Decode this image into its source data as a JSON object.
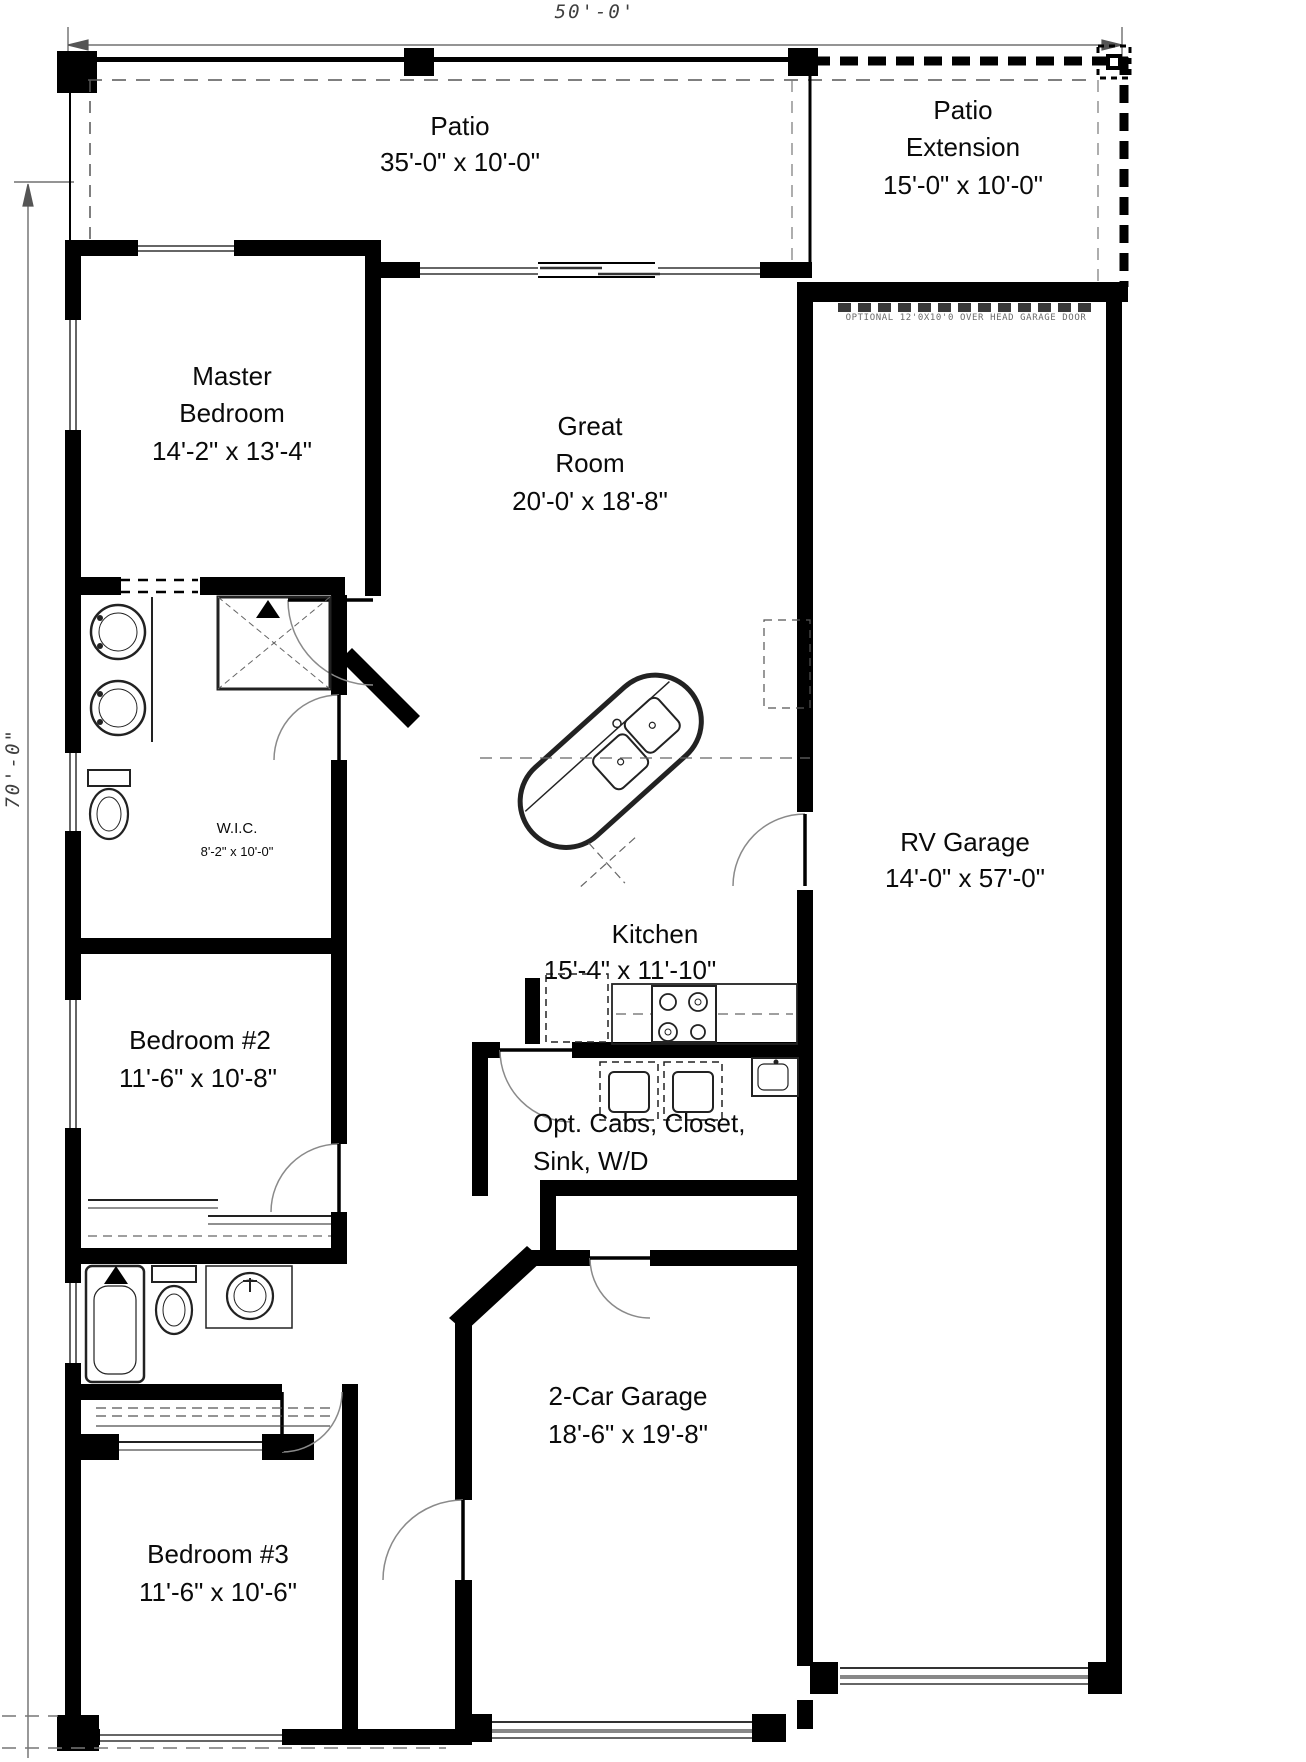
{
  "drawing": {
    "overall_width_label": "50'-0'",
    "overall_depth_label": "70'-0\"",
    "note_rv_door": "OPTIONAL 12'0X10'0 OVER HEAD GARAGE DOOR",
    "rooms": {
      "patio": {
        "name": "Patio",
        "size": "35'-0\" x 10'-0\""
      },
      "patio_extension": {
        "name_line1": "Patio",
        "name_line2": "Extension",
        "size": "15'-0\" x 10'-0\""
      },
      "master_bedroom": {
        "name_line1": "Master",
        "name_line2": "Bedroom",
        "size": "14'-2\" x 13'-4\""
      },
      "great_room": {
        "name_line1": "Great",
        "name_line2": "Room",
        "size": "20'-0' x 18'-8\""
      },
      "wic": {
        "name": "W.I.C.",
        "size": "8'-2\" x 10'-0\""
      },
      "kitchen": {
        "name": "Kitchen",
        "size": "15'-4\" x 11'-10\""
      },
      "rv_garage": {
        "name": "RV Garage",
        "size": "14'-0\" x 57'-0\""
      },
      "bedroom_2": {
        "name": "Bedroom #2",
        "size": "11'-6\" x 10'-8\""
      },
      "opt_cabs": {
        "line1": "Opt. Cabs, Closet,",
        "line2": "Sink, W/D"
      },
      "two_car_garage": {
        "name": "2-Car Garage",
        "size": "18'-6\" x 19'-8\""
      },
      "bedroom_3": {
        "name": "Bedroom #3",
        "size": "11'-6\" x 10'-6\""
      }
    },
    "colors": {
      "wall": "#000000",
      "thin_line": "#777777",
      "background": "#ffffff",
      "note_text": "#6b6b6b"
    }
  }
}
